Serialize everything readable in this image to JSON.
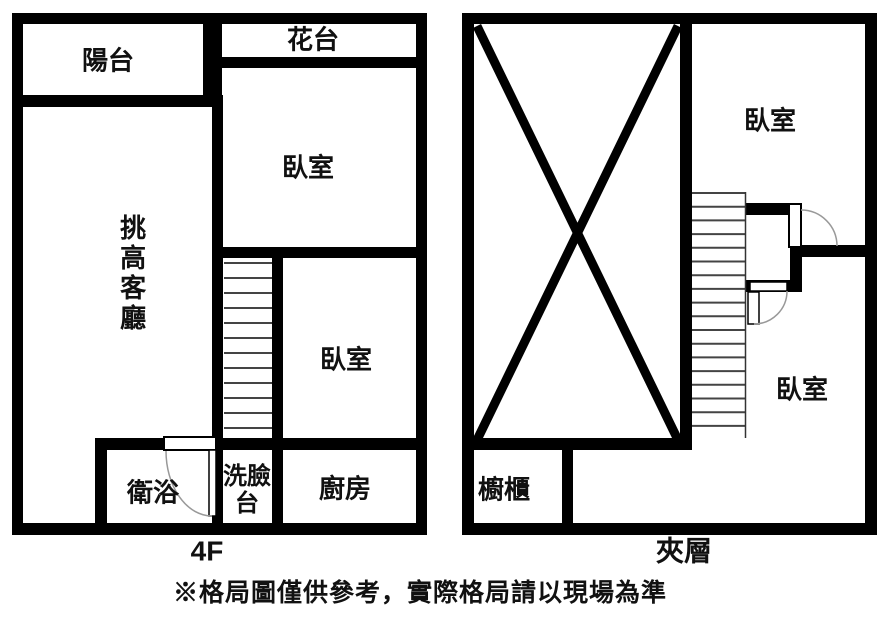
{
  "plans": {
    "left": {
      "floor_label": "4F",
      "rooms": {
        "balcony": "陽台",
        "flower_bed": "花台",
        "bedroom_top": "臥室",
        "living_room": "挑高客廳",
        "bedroom_mid": "臥室",
        "bathroom": "衛浴",
        "washbasin": "洗臉台",
        "kitchen": "廚房"
      }
    },
    "right": {
      "floor_label": "夾層",
      "rooms": {
        "bedroom_top": "臥室",
        "bedroom_bottom": "臥室",
        "cabinet": "櫥櫃"
      }
    }
  },
  "disclaimer": "※格局圖僅供參考，實際格局請以現場為準",
  "colors": {
    "wall": "#000000",
    "background": "#ffffff",
    "stair_tread": "#444444",
    "door_arc": "#999999"
  }
}
